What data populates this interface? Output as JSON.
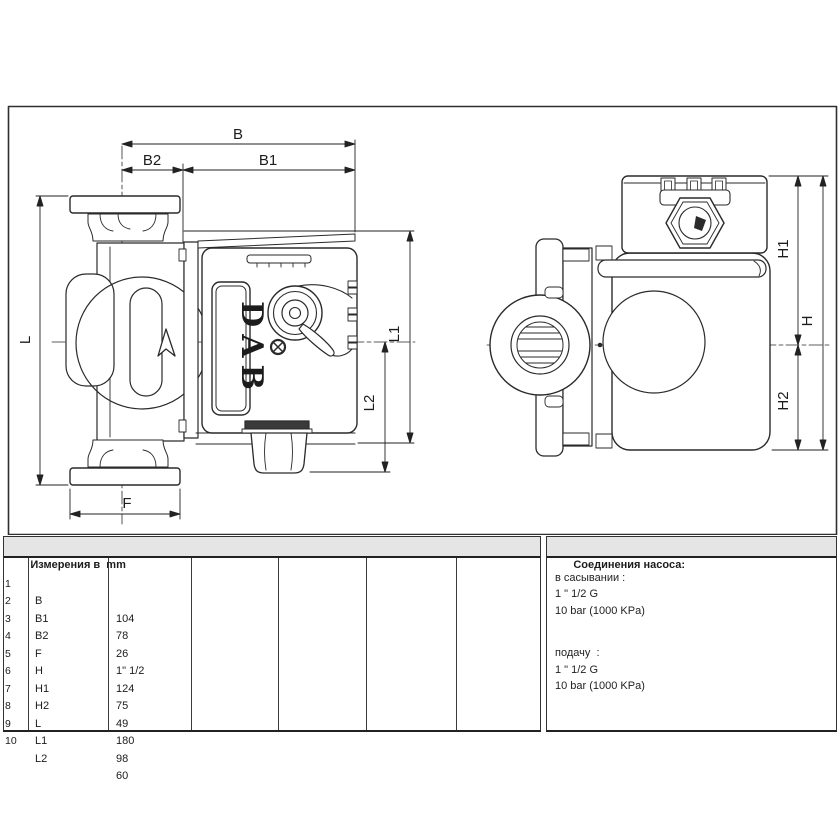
{
  "drawing": {
    "brand": "DAB",
    "labels": {
      "b": "B",
      "b1": "B1",
      "b2": "B2",
      "l": "L",
      "l1": "L1",
      "l2": "L2",
      "f": "F",
      "h": "H",
      "h1": "H1",
      "h2": "H2"
    }
  },
  "table": {
    "header": "Измерения в  mm",
    "rows": [
      {
        "num": "1",
        "label": "B",
        "value": "104"
      },
      {
        "num": "2",
        "label": "B1",
        "value": "78"
      },
      {
        "num": "3",
        "label": "B2",
        "value": "26"
      },
      {
        "num": "4",
        "label": "F",
        "value": "1\" 1/2"
      },
      {
        "num": "5",
        "label": "H",
        "value": "124"
      },
      {
        "num": "6",
        "label": "H1",
        "value": "75"
      },
      {
        "num": "7",
        "label": "H2",
        "value": "49"
      },
      {
        "num": "8",
        "label": "L",
        "value": "180"
      },
      {
        "num": "9",
        "label": "L1",
        "value": "98"
      },
      {
        "num": "10",
        "label": "L2",
        "value": "60"
      }
    ]
  },
  "connections": {
    "header": "Соединения насоса:",
    "suction_label": "в сасывании :",
    "suction_size": "1 \" 1/2 G",
    "suction_pressure": "10 bar (1000 KPa)",
    "delivery_label": "подачу  :",
    "delivery_size": "1 \" 1/2 G",
    "delivery_pressure": "10 bar (1000 KPa)"
  }
}
